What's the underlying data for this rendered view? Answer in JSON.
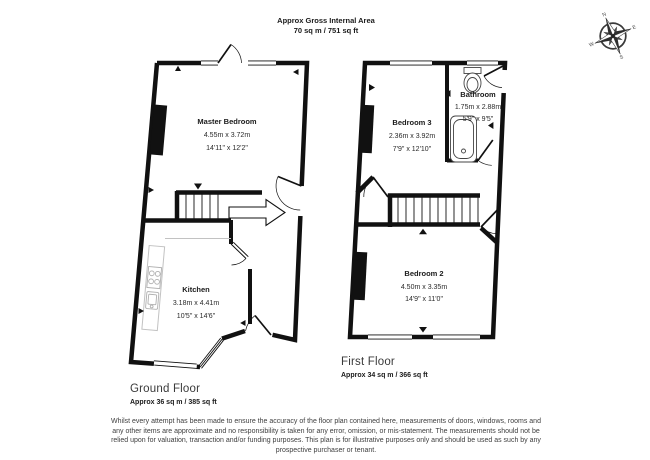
{
  "header": {
    "line1": "Approx Gross Internal Area",
    "line2": "70 sq m / 751 sq ft"
  },
  "compass": {
    "n": "N",
    "e": "E",
    "s": "S",
    "w": "W"
  },
  "floors": [
    {
      "name": "Ground Floor",
      "area": "Approx 36 sq m / 385 sq ft",
      "rooms": [
        {
          "name": "Master Bedroom",
          "metric": "4.55m x 3.72m",
          "imperial": "14'11\" x 12'2\""
        },
        {
          "name": "Kitchen",
          "metric": "3.18m x 4.41m",
          "imperial": "10'5\" x 14'6\""
        }
      ]
    },
    {
      "name": "First Floor",
      "area": "Approx 34 sq m / 366 sq ft",
      "rooms": [
        {
          "name": "Bedroom 3",
          "metric": "2.36m x 3.92m",
          "imperial": "7'9\" x 12'10\""
        },
        {
          "name": "Bathroom",
          "metric": "1.75m x 2.88m",
          "imperial": "5'9\" x 9'5\""
        },
        {
          "name": "Bedroom 2",
          "metric": "4.50m x 3.35m",
          "imperial": "14'9\" x 11'0\""
        }
      ]
    }
  ],
  "disclaimer": "Whilst every attempt has been made to ensure the accuracy of the floor plan contained here, measurements of doors, windows, rooms and any other items are approximate and no responsibility is taken for any error, omission, or mis-statement. The measurements should not be relied upon for valuation, transaction and/or funding purposes. This plan is for illustrative purposes only and should be used as such by any prospective purchaser or tenant.",
  "colors": {
    "wall": "#111111",
    "counter_outline": "#c2c2c2",
    "label_text": "#1a1a1a"
  }
}
